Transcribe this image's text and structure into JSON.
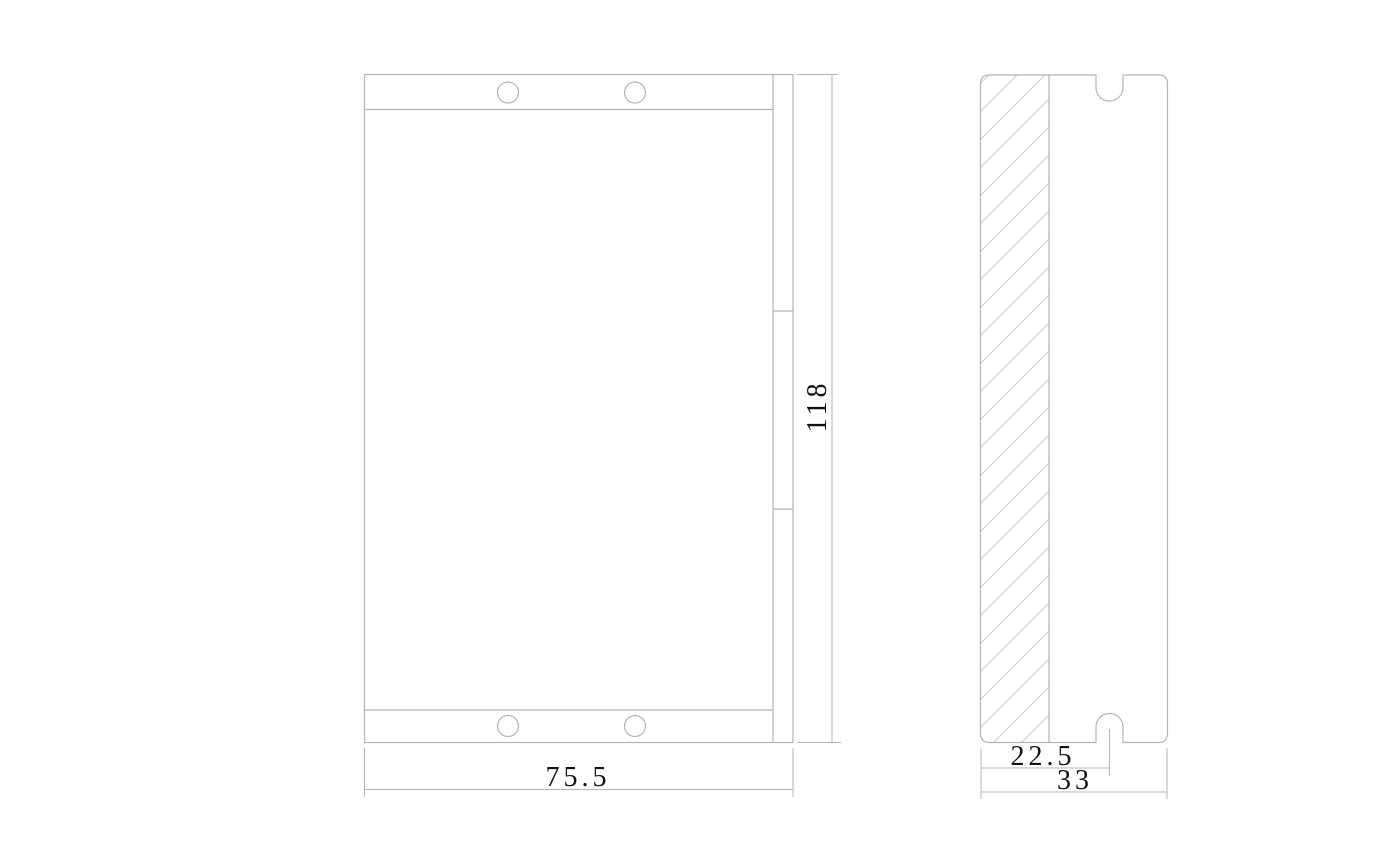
{
  "colors": {
    "background": "#ffffff",
    "line": "#b4b4b4",
    "hatch": "#cccccc",
    "text": "#111111"
  },
  "front_view": {
    "width_dim": "75.5",
    "height_dim": "118"
  },
  "side_view": {
    "notch_offset_dim": "22.5",
    "width_dim": "33"
  }
}
